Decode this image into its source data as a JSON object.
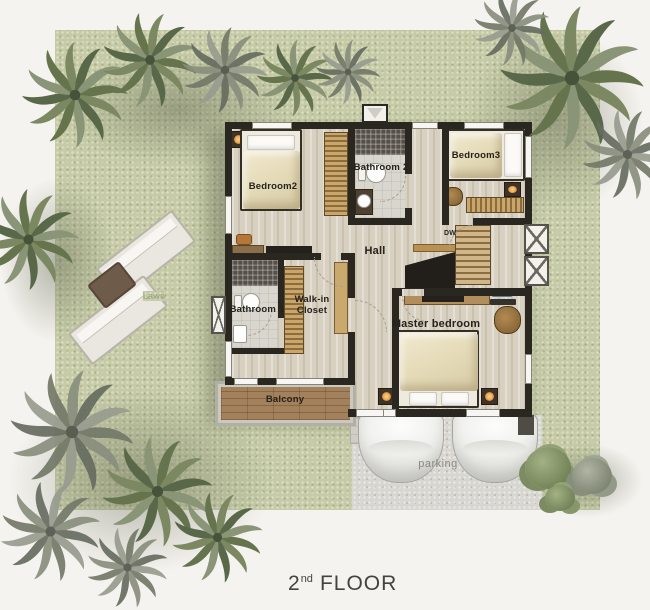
{
  "title": {
    "number": "2",
    "ordinal": "nd",
    "word": "FLOOR"
  },
  "rooms": {
    "bedroom2": "Bedroom2",
    "bathroom2": "Bathroom 2",
    "bedroom3": "Bedroom3",
    "hall": "Hall",
    "dw": "DW",
    "walkin_line1": "Walk-in",
    "walkin_line2": "Closet",
    "bathroom1": "Bathroom 1",
    "master_bedroom": "Master bedroom",
    "balcony": "Balcony"
  },
  "outdoor": {
    "parking": "parking",
    "lawn": "Lawn"
  },
  "colors": {
    "background": "#f5f3ef",
    "lawn": "#c6cba6",
    "wall": "#2a2721",
    "wood_floor": "#d8d1c1",
    "wardrobe_wood": "#c9a66a",
    "balcony_wood": "#a2815c",
    "parking": "#d8d6d1",
    "label_dark": "#25221c",
    "label_muted": "#8a897f",
    "palm_green": "#66744e"
  }
}
